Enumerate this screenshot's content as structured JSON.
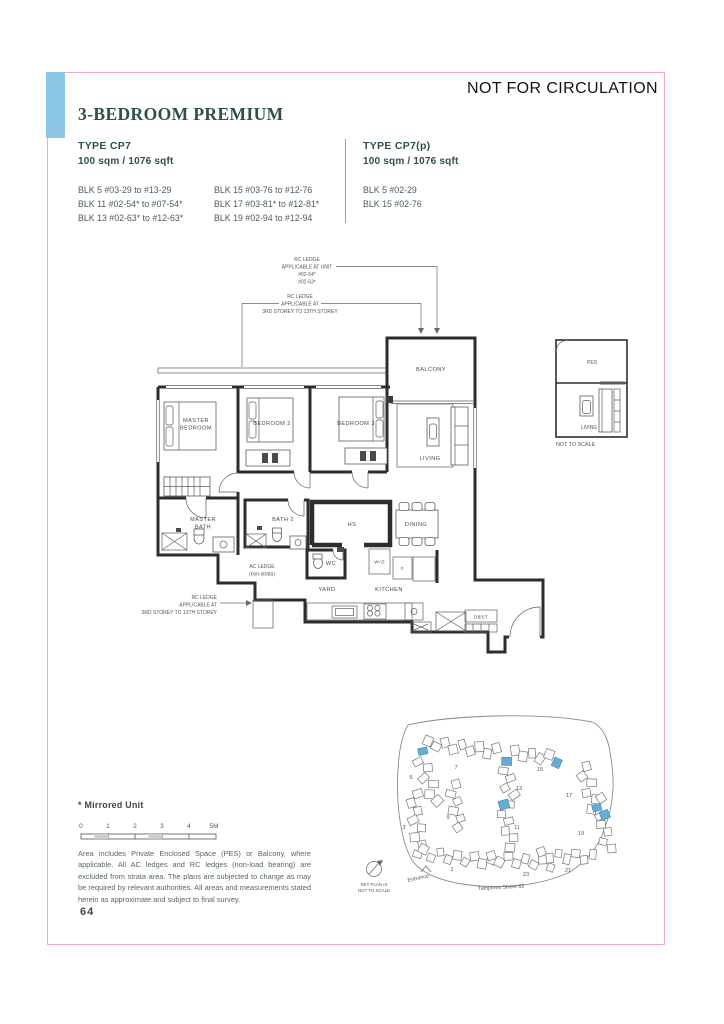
{
  "page": {
    "watermark": "NOT FOR CIRCULATION",
    "title": "3-BEDROOM PREMIUM",
    "page_number": "64",
    "accent_blue": "#8cc7e6",
    "border_pink": "#f3abc9",
    "heading_teal": "#2f4f4d"
  },
  "types": [
    {
      "name": "TYPE CP7",
      "area": "100 sqm / 1076 sqft",
      "col1": [
        "BLK 5 #03-29 to #13-29",
        "BLK 11 #02-54* to #07-54*",
        "BLK 13 #02-63* to #12-63*"
      ],
      "col2": [
        "BLK 15 #03-76 to #12-76",
        "BLK 17 #03-81* to #12-81*",
        "BLK 19 #02-94 to #12-94"
      ]
    },
    {
      "name": "TYPE CP7(p)",
      "area": "100 sqm / 1076 sqft",
      "col1": [
        "BLK 5 #02-29",
        "BLK 15 #02-76"
      ]
    }
  ],
  "floorplan": {
    "ann_unit": [
      "RC LEDGE",
      "APPLICABLE AT UNIT",
      "#02-54*",
      "#02-63*"
    ],
    "ann_storey_top": [
      "RC LEDGE",
      "APPLICABLE AT",
      "3RD STOREY TO 13TH STOREY"
    ],
    "ann_storey_left": [
      "RC LEDGE",
      "APPLICABLE AT",
      "3RD STOREY TO 13TH STOREY"
    ],
    "rooms": {
      "balcony": "BALCONY",
      "master": [
        "MASTER",
        "BEDROOM"
      ],
      "bedroom2": "BEDROOM 2",
      "bedroom3": "BEDROOM 3",
      "living": "LIVING",
      "master_bath": [
        "MASTER",
        "BATH"
      ],
      "bath2": "BATH 2",
      "hs": "HS",
      "dining": "DINING",
      "wc": "WC",
      "yard": "YARD",
      "kitchen": "KITCHEN",
      "wd": "W+D",
      "fridge": "F",
      "dbst": "DB/ST",
      "ac_ledge": [
        "AC LEDGE",
        "(non-strata)"
      ]
    }
  },
  "inset": {
    "pes": "PES",
    "living": "LIVING",
    "caption": "NOT TO SCALE"
  },
  "siteplan": {
    "street": "Tampines Street 62",
    "entrance": "Entrance",
    "keyplan_note": [
      "KEY PLAN IS",
      "NOT TO SCALE"
    ],
    "highlight_color": "#64aed6",
    "blocks": [
      {
        "label": "7",
        "cx": 462,
        "cy": 747,
        "angle": 6,
        "n": 9,
        "blue": [],
        "lx": 456,
        "ly": 769
      },
      {
        "label": "5",
        "cx": 427,
        "cy": 777,
        "angle": 72,
        "n": 7,
        "blue": [
          0
        ],
        "lx": 411,
        "ly": 779
      },
      {
        "label": "15",
        "cx": 536,
        "cy": 756,
        "angle": 8,
        "n": 6,
        "blue": [
          5
        ],
        "lx": 540,
        "ly": 771
      },
      {
        "label": "13",
        "cx": 508,
        "cy": 783,
        "angle": 78,
        "n": 6,
        "blue": [
          0
        ],
        "lx": 519,
        "ly": 790
      },
      {
        "label": "9",
        "cx": 456,
        "cy": 806,
        "angle": 80,
        "n": 6,
        "blue": [],
        "lx": 448,
        "ly": 819
      },
      {
        "label": "3",
        "cx": 417,
        "cy": 824,
        "angle": 84,
        "n": 8,
        "blue": [],
        "lx": 404,
        "ly": 829
      },
      {
        "label": "11",
        "cx": 507,
        "cy": 826,
        "angle": 75,
        "n": 6,
        "blue": [
          0
        ],
        "lx": 517,
        "ly": 829
      },
      {
        "label": "17",
        "cx": 590,
        "cy": 792,
        "angle": 75,
        "n": 7,
        "blue": [],
        "lx": 569,
        "ly": 797
      },
      {
        "label": "19",
        "cx": 603,
        "cy": 824,
        "angle": 78,
        "n": 7,
        "blue": [
          1,
          2
        ],
        "lx": 581,
        "ly": 835
      },
      {
        "label": "1",
        "cx": 457,
        "cy": 858,
        "angle": 8,
        "n": 9,
        "blue": [],
        "lx": 452,
        "ly": 871
      },
      {
        "label": "23",
        "cx": 521,
        "cy": 861,
        "angle": 5,
        "n": 8,
        "blue": [],
        "lx": 526,
        "ly": 876
      },
      {
        "label": "21",
        "cx": 567,
        "cy": 856,
        "angle": 2,
        "n": 7,
        "blue": [],
        "lx": 568,
        "ly": 872
      }
    ]
  },
  "footer": {
    "mirrored": "* Mirrored Unit",
    "scale_ticks": [
      "0",
      "1",
      "2",
      "3",
      "4",
      "5M"
    ],
    "disclaimer": "Area includes Private Enclosed Space (PES) or Balcony, where applicable. All AC ledges and RC ledges (non-load bearing) are excluded from strata area. The plans are subjected to change as may be required by relevant authorities. All areas and measurements stated herein as approximate and subject to final survey."
  }
}
